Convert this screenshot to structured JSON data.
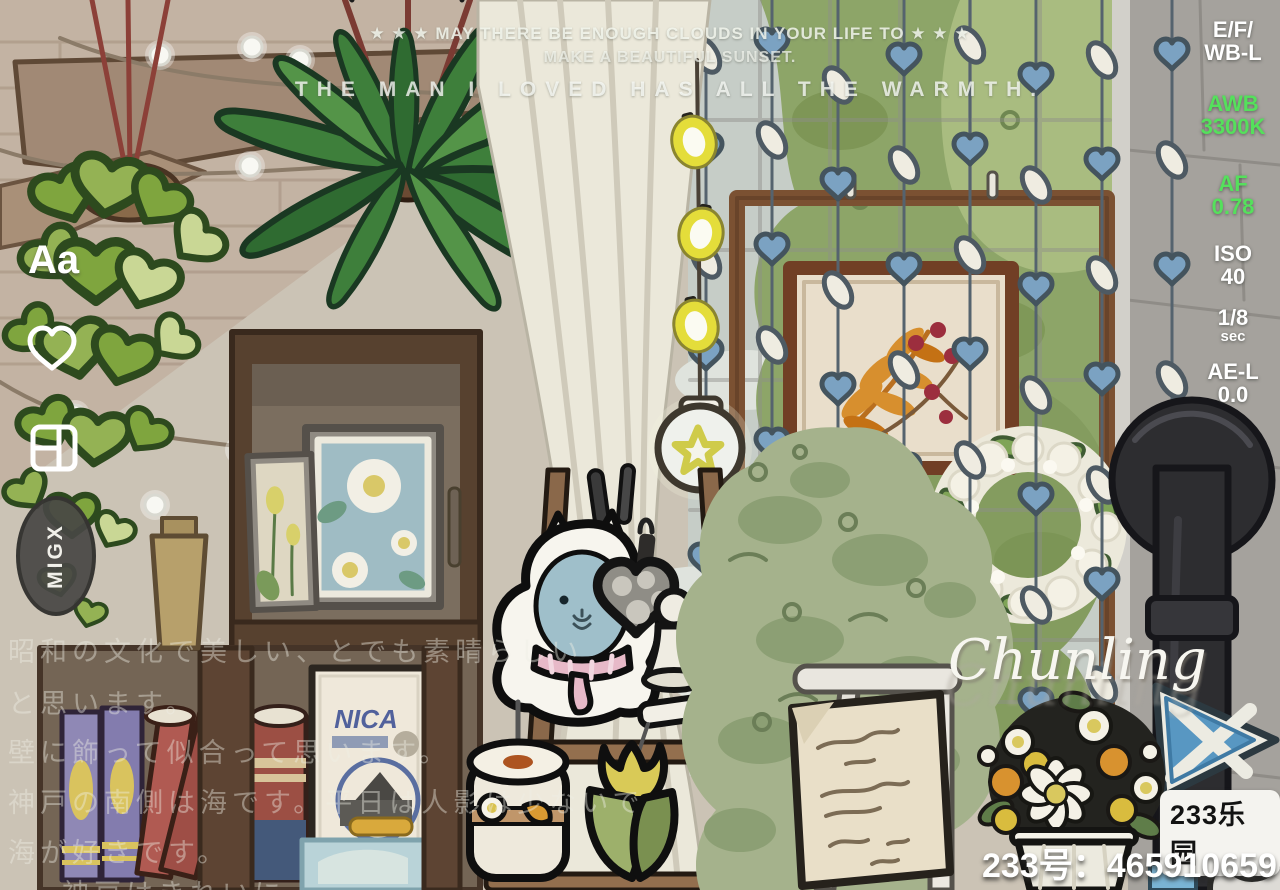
{
  "captions": {
    "line1": "★ ★ ★ MAY THERE BE ENOUGH CLOUDS IN YOUR LIFE TO ★ ★ ★",
    "line2": "MAKE A BEAUTIFUL SUNSET.",
    "line3": "THE MAN I LOVED HAS ALL THE WARMTH."
  },
  "camera_hud": {
    "items": [
      {
        "line1": "E/F/",
        "line2": "WB-L",
        "color": "#ffffff"
      },
      {
        "line1": "AWB",
        "line2": "3300K",
        "color": "#55e05c"
      },
      {
        "line1": "AF",
        "line2": "0.78",
        "color": "#55e05c"
      },
      {
        "line1": "ISO",
        "line2": "40",
        "color": "#ffffff"
      },
      {
        "line1": "1/8",
        "line2": "sec",
        "color": "#ffffff"
      },
      {
        "line1": "AE-L",
        "line2": "0.0",
        "color": "#ffffff"
      }
    ]
  },
  "toolbar": {
    "text_tool_label": "Aa",
    "sticker_label": "MIGX"
  },
  "japanese_caption": {
    "lines": [
      "昭和の文化で美しい、とでも素晴らしい",
      "と思います。",
      "壁に飾って似合って思います。",
      "神戸の南側は海です。平日は人影は少ないで",
      "海が好きです。",
      "神戸はきれいに…"
    ]
  },
  "poster": {
    "title": "NICA"
  },
  "signature": "Chunling",
  "footer": {
    "room_id": "233号：465910659",
    "platform_badge": "233乐园"
  },
  "colors": {
    "hud_green": "#55e05c",
    "hud_white": "#ffffff",
    "hearts_blue": "#7ba2c2",
    "wood_lattice": "#7b5132",
    "curtain": "#ebe8da",
    "pine_green": "#a5b28c",
    "flag_blue": "#5897c2"
  }
}
